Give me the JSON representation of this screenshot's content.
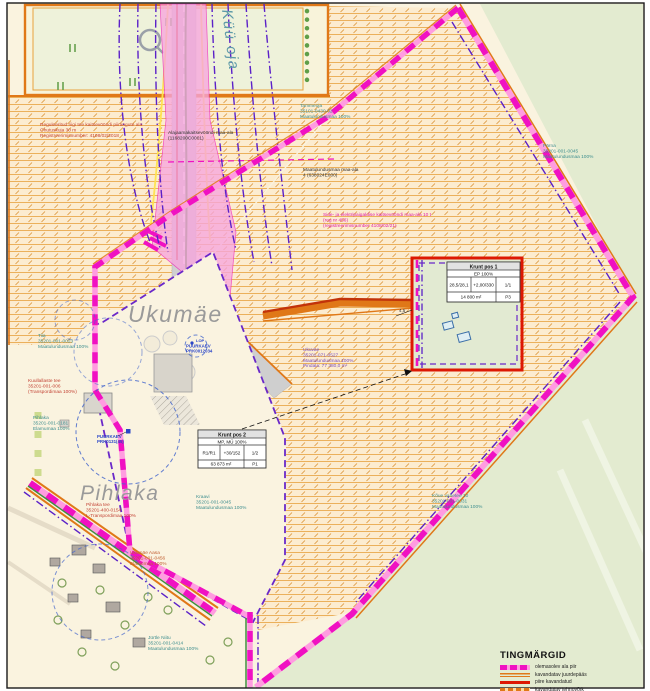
{
  "palette": {
    "boundary_magenta": "#f011c2",
    "boundary_pink": "#ff9ce0",
    "utility_purple": "#5b21c8",
    "road_orange": "#e07818",
    "building_area_red": "#dd1803",
    "outside_green": "#e3ebd0",
    "hatch_orange": "#e9a94e",
    "protection_zone_pink": "#f7a6de"
  },
  "titles": {
    "ukumae": "Ukumäe",
    "pihlaka": "Pihlaka",
    "stream": "Küü oja"
  },
  "labels": {
    "reg_note": {
      "lines": [
        "Reguleeritud riigi tee kaitsevööndi piirangute ala",
        "Ohutuskuja 30 m",
        "Registreerimisnumber: 4108/02/2018"
      ]
    },
    "alajaama": {
      "lines": [
        "Alajaamakaitsevööndi maa-ala",
        "(1168200C0001)"
      ]
    },
    "tammeoja": {
      "lines": [
        "Tammeoja",
        "35101-0430-02",
        "Maatulundusmaa 100%"
      ]
    },
    "keskosa": {
      "lines": [
        "Maatulundusmaa maa-ala",
        "4 (638024E000)"
      ]
    },
    "side_note": {
      "lines": [
        "Side- ja elektripaigaldise kaitsevööndi maa-ala 10 t",
        "(reg nr 456)",
        "(registreerimisnumber 4108/02/21)"
      ]
    },
    "parna": {
      "lines": [
        "Pärna",
        "35201-001-0045",
        "Maatulundusmaa 100%"
      ]
    },
    "ukuvae": {
      "lines": [
        "Ukuväe",
        "35201-071-0527",
        "Maatulundusmaa 100%",
        "Pindala: 77 380,0 m²"
      ]
    },
    "tiia": {
      "lines": [
        "Tiia",
        "35201-001-0023",
        "Maatulundusmaa 100%"
      ]
    },
    "kuullallaste": {
      "lines": [
        "Kuullallaste tee",
        "35201-001-006",
        "(Transpordimaa 100%)"
      ]
    },
    "pihlaka_parcel": {
      "lines": [
        "Pihlaka",
        "35201-001-0181",
        "Elamumaa 100%"
      ]
    },
    "pihlaka_tee": {
      "lines": [
        "Pihlaka tee",
        "35201-400-0154",
        "L-Transpordimaa 100%"
      ]
    },
    "kraavi": {
      "lines": [
        "Kraavi",
        "35201-001-0045",
        "Maatulundusmaa 100%"
      ]
    },
    "ukumae_aasa": {
      "lines": [
        "Ukumäe Aasa",
        "35201-001-0456",
        "Elamumaa 100%"
      ]
    },
    "jurtle": {
      "lines": [
        "Jürtle Niitu",
        "35201-001-0414",
        "Maatulundusmaa 100%"
      ]
    },
    "koigi": {
      "lines": [
        "Kõue vahetee 10",
        "35201-001-0031",
        "Maatulundusmaa 100%"
      ]
    },
    "puurkaev1": {
      "lines": [
        "PUURKAEV",
        "PRK0131(45)"
      ]
    },
    "puurkaev2": {
      "lines": [
        "PUURKAEV",
        "PRK0012034"
      ],
      "tag": "LOP"
    },
    "dim": "4,5"
  },
  "tables": {
    "pos1": {
      "title": "Krunt pos 1",
      "usage": "EP 100%",
      "cells": [
        "28,5/28,1",
        "+2,00/330",
        "1/1"
      ],
      "area": "14 800 m²",
      "tag": "P3"
    },
    "pos2": {
      "title": "Krunt pos 2",
      "usage": "MP, MÜ 100%",
      "cells": [
        "R1/R1",
        "+30/152",
        "1/2"
      ],
      "area": "63 873 m²",
      "tag": "P1"
    }
  },
  "legend": {
    "title": "TINGMÄRGID",
    "items": [
      {
        "label": "olemasolev ala piir"
      },
      {
        "label": "kavandatav juurdepääs"
      },
      {
        "label": "piire kavandatud"
      },
      {
        "label": "kavandatav tehnovõrk"
      }
    ]
  }
}
